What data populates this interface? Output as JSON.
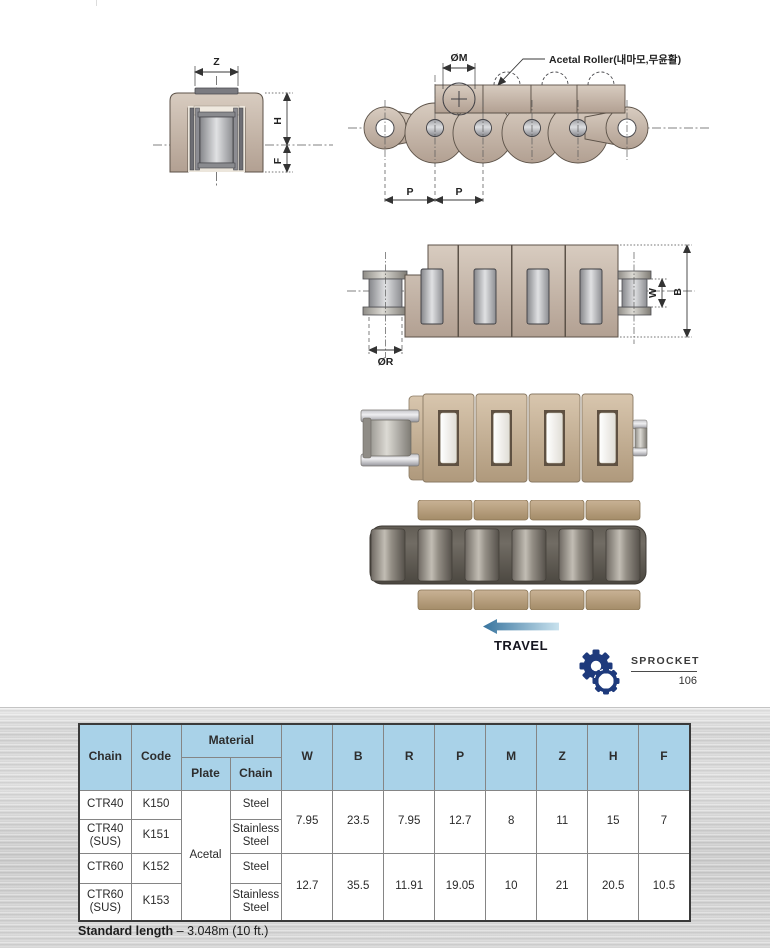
{
  "colors": {
    "table_header_bg": "#a9d2e8",
    "sprocket_icon": "#1e3a7c",
    "drawing_tan": "#c2b2a4",
    "travel_arrow_dark": "#38749e",
    "travel_arrow_light": "#c9e2ee"
  },
  "diagram": {
    "roller_note": "Acetal Roller(내마모,무윤활)",
    "labels": {
      "z": "Z",
      "h": "H",
      "f": "F",
      "m_dia": "ØM",
      "p_left": "P",
      "p_right": "P",
      "r_dia": "ØR",
      "w": "W",
      "b": "B"
    }
  },
  "travel": {
    "label": "TRAVEL"
  },
  "sprocket": {
    "label": "SPROCKET",
    "page_number": "106"
  },
  "table": {
    "headers": {
      "chain": "Chain",
      "code": "Code",
      "material": "Material",
      "plate": "Plate",
      "chain_sub": "Chain",
      "dims": [
        "W",
        "B",
        "R",
        "P",
        "M",
        "Z",
        "H",
        "F"
      ]
    },
    "plate_material": "Acetal",
    "rows": [
      {
        "chain": "CTR40",
        "code": "K150",
        "chain_material": "Steel"
      },
      {
        "chain": "CTR40 (SUS)",
        "code": "K151",
        "chain_material": "Stainless Steel"
      },
      {
        "chain": "CTR60",
        "code": "K152",
        "chain_material": "Steel"
      },
      {
        "chain": "CTR60 (SUS)",
        "code": "K153",
        "chain_material": "Stainless Steel"
      }
    ],
    "value_groups": [
      {
        "values": [
          "7.95",
          "23.5",
          "7.95",
          "12.7",
          "8",
          "11",
          "15",
          "7"
        ]
      },
      {
        "values": [
          "12.7",
          "35.5",
          "11.91",
          "19.05",
          "10",
          "21",
          "20.5",
          "10.5"
        ]
      }
    ]
  },
  "footer": {
    "standard_length_label": "Standard length",
    "standard_length_value": "– 3.048m (10 ft.)"
  }
}
